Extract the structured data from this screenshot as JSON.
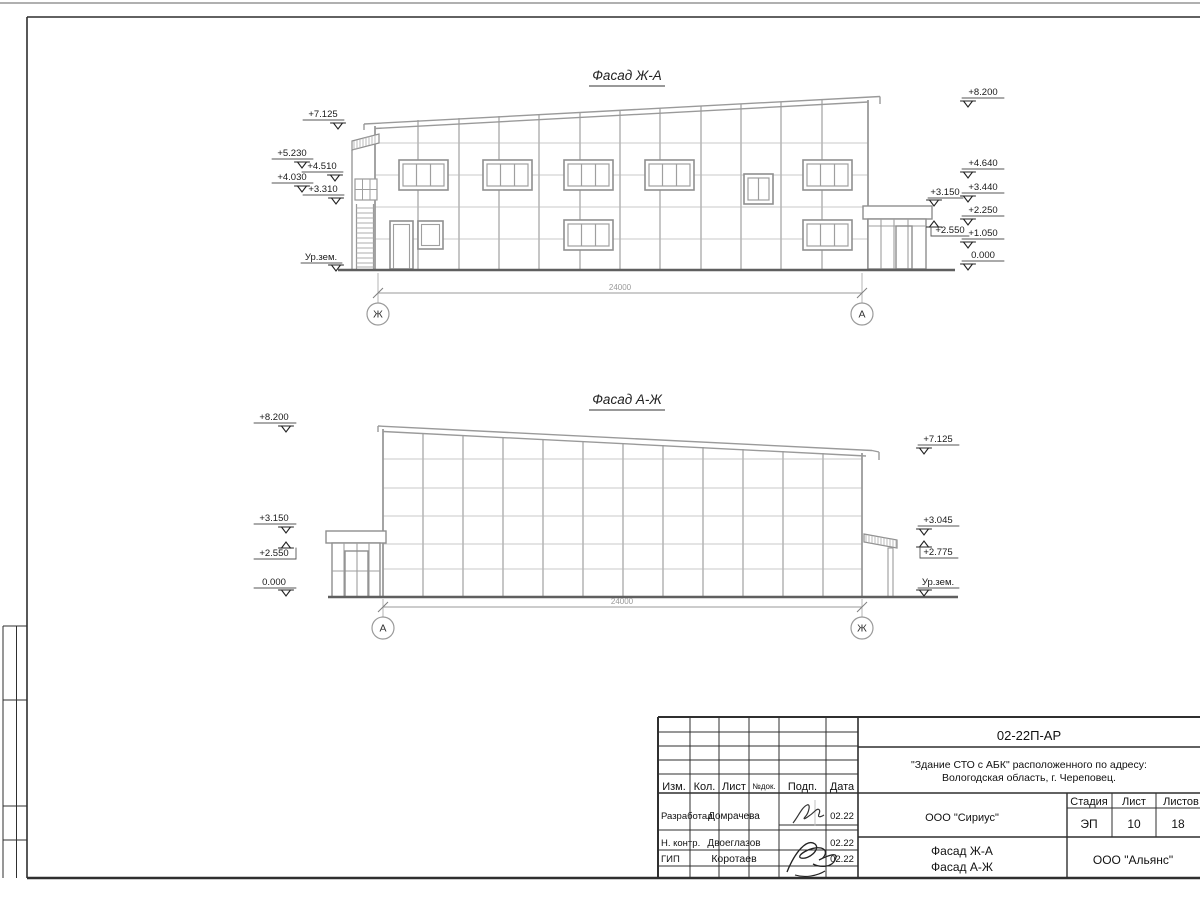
{
  "facade1": {
    "title": "Фасад Ж-А",
    "dim": "24000",
    "axis_left": "Ж",
    "axis_right": "А",
    "marks_left": [
      "+7.125",
      "+5.230",
      "+4.510",
      "+4.030",
      "+3.310",
      "Ур.зем."
    ],
    "marks_right": [
      "+8.200",
      "+4.640",
      "+3.440",
      "+2.250",
      "+1.050",
      "0.000"
    ],
    "marks_inner": [
      "+3.150",
      "+2.550"
    ]
  },
  "facade2": {
    "title": "Фасад А-Ж",
    "dim": "24000",
    "axis_left": "А",
    "axis_right": "Ж",
    "marks_left": [
      "+8.200",
      "+3.150",
      "+2.550",
      "0.000"
    ],
    "marks_right": [
      "+7.125",
      "+3.045",
      "+2.775",
      "Ур.зем."
    ]
  },
  "titleblock": {
    "doc_code": "02-22П-АР",
    "object_line1": "\"Здание СТО с АБК\" расположенного по адресу:",
    "object_line2": "Вологодская область, г. Череповец.",
    "designer_company": "ООО \"Сириус\"",
    "contractor_company": "ООО \"Альянс\"",
    "stage_label": "Стадия",
    "sheet_label": "Лист",
    "sheets_label": "Листов",
    "stage": "ЭП",
    "sheet_no": "10",
    "sheets_total": "18",
    "sheet_title_line1": "Фасад Ж-А",
    "sheet_title_line2": "Фасад А-Ж",
    "cols": {
      "izm": "Изм.",
      "kol": "Кол.",
      "list": "Лист",
      "ndok": "№док.",
      "podp": "Подп.",
      "data": "Дата"
    },
    "rows": [
      {
        "role": "Разработал",
        "name": "Домрачева",
        "date": "02.22"
      },
      {
        "role": "Н. контр.",
        "name": "Двоеглазов",
        "date": "02.22"
      },
      {
        "role": "ГИП",
        "name": "Коротаев",
        "date": "02.22"
      }
    ]
  }
}
